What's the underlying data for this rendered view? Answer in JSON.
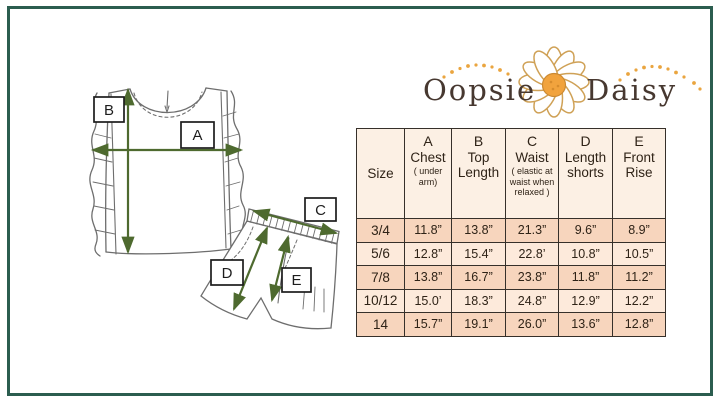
{
  "frame": {
    "border_color": "#2b5d4f"
  },
  "logo": {
    "word_left": "Oopsie",
    "word_right": "Daisy",
    "text_color": "#473830",
    "accent_dot_color": "#eaa53f",
    "flower_center_color": "#f1a33d",
    "petal_outline_color": "#cfa156"
  },
  "diagram": {
    "arrow_color": "#4e6a2f",
    "sketch_color": "#6e6e6e",
    "labels": {
      "a": "A",
      "b": "B",
      "c": "C",
      "d": "D",
      "e": "E"
    }
  },
  "size_table": {
    "header_bg": "#fcf0e4",
    "row_dark_bg": "#f7d5bd",
    "row_light_bg": "#fdeadb",
    "grid_color": "#36302a",
    "text_color": "#2f2317",
    "columns": [
      {
        "letter": "",
        "title": "Size",
        "note": ""
      },
      {
        "letter": "A",
        "title": "Chest",
        "note": "( under arm)"
      },
      {
        "letter": "B",
        "title": "Top Length",
        "note": ""
      },
      {
        "letter": "C",
        "title": "Waist",
        "note": "( elastic at waist when relaxed )"
      },
      {
        "letter": "D",
        "title": "Length shorts",
        "note": ""
      },
      {
        "letter": "E",
        "title": "Front Rise",
        "note": ""
      }
    ],
    "rows": [
      {
        "size": "3/4",
        "values": [
          "11.8”",
          "13.8”",
          "21.3”",
          "9.6”",
          "8.9”"
        ]
      },
      {
        "size": "5/6",
        "values": [
          "12.8”",
          "15.4”",
          "22.8’",
          "10.8”",
          "10.5”"
        ]
      },
      {
        "size": "7/8",
        "values": [
          "13.8”",
          "16.7”",
          "23.8”",
          "11.8”",
          "11.2”"
        ]
      },
      {
        "size": "10/12",
        "values": [
          "15.0’",
          "18.3”",
          "24.8”",
          "12.9”",
          "12.2”"
        ]
      },
      {
        "size": "14",
        "values": [
          "15.7”",
          "19.1”",
          "26.0”",
          "13.6”",
          "12.8”"
        ]
      }
    ]
  }
}
